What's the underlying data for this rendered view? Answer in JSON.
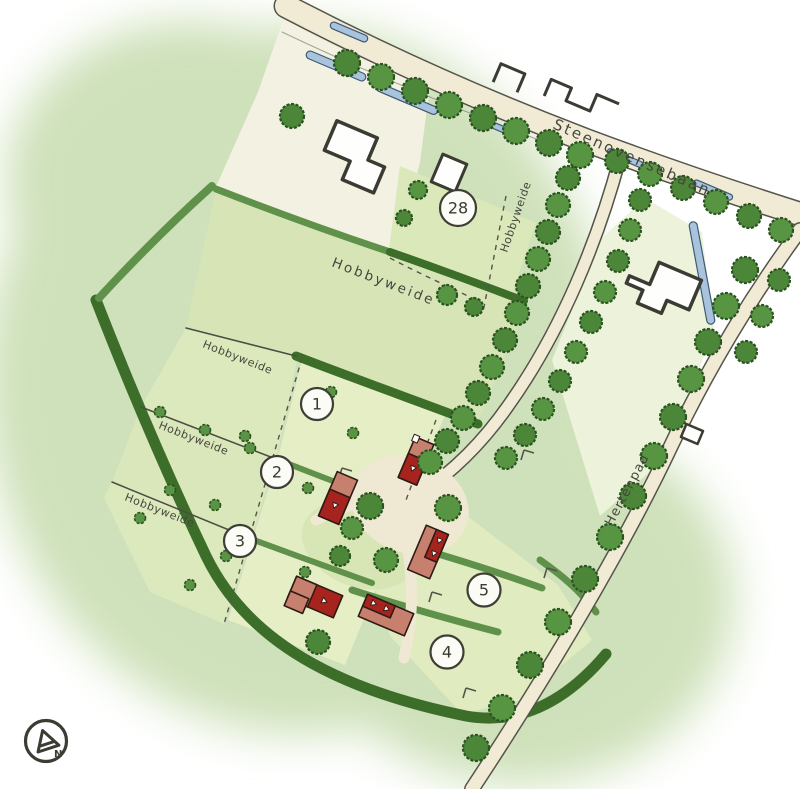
{
  "map": {
    "type": "illustrated-site-plan",
    "roads": [
      {
        "name": "Steenovensebaan"
      },
      {
        "name": "Hertenpad"
      }
    ],
    "fields": [
      {
        "label": "Hobbyweide",
        "position": "center"
      },
      {
        "label": "Hobbyweide",
        "position": "north"
      },
      {
        "label": "Hobbyweide",
        "position": "west-upper"
      },
      {
        "label": "Hobbyweide",
        "position": "west-middle"
      },
      {
        "label": "Hobbyweide",
        "position": "west-lower"
      }
    ],
    "plots": [
      {
        "number": "28"
      },
      {
        "number": "1"
      },
      {
        "number": "2"
      },
      {
        "number": "3"
      },
      {
        "number": "4"
      },
      {
        "number": "5"
      }
    ],
    "compass": {
      "label": "N"
    },
    "colors": {
      "background_blob": "#cfe1ba",
      "meadow": "#d8e6b8",
      "parcel": "#e3edc3",
      "hedge_dark": "#3c6e2a",
      "hedge_light": "#5f914a",
      "tree": "#4d883a",
      "road": "#f1ebd5",
      "water": "#a9c3dd",
      "roof_dark": "#a6231e",
      "roof_light": "#c8806e",
      "building_outline": "#3b3b33"
    }
  }
}
